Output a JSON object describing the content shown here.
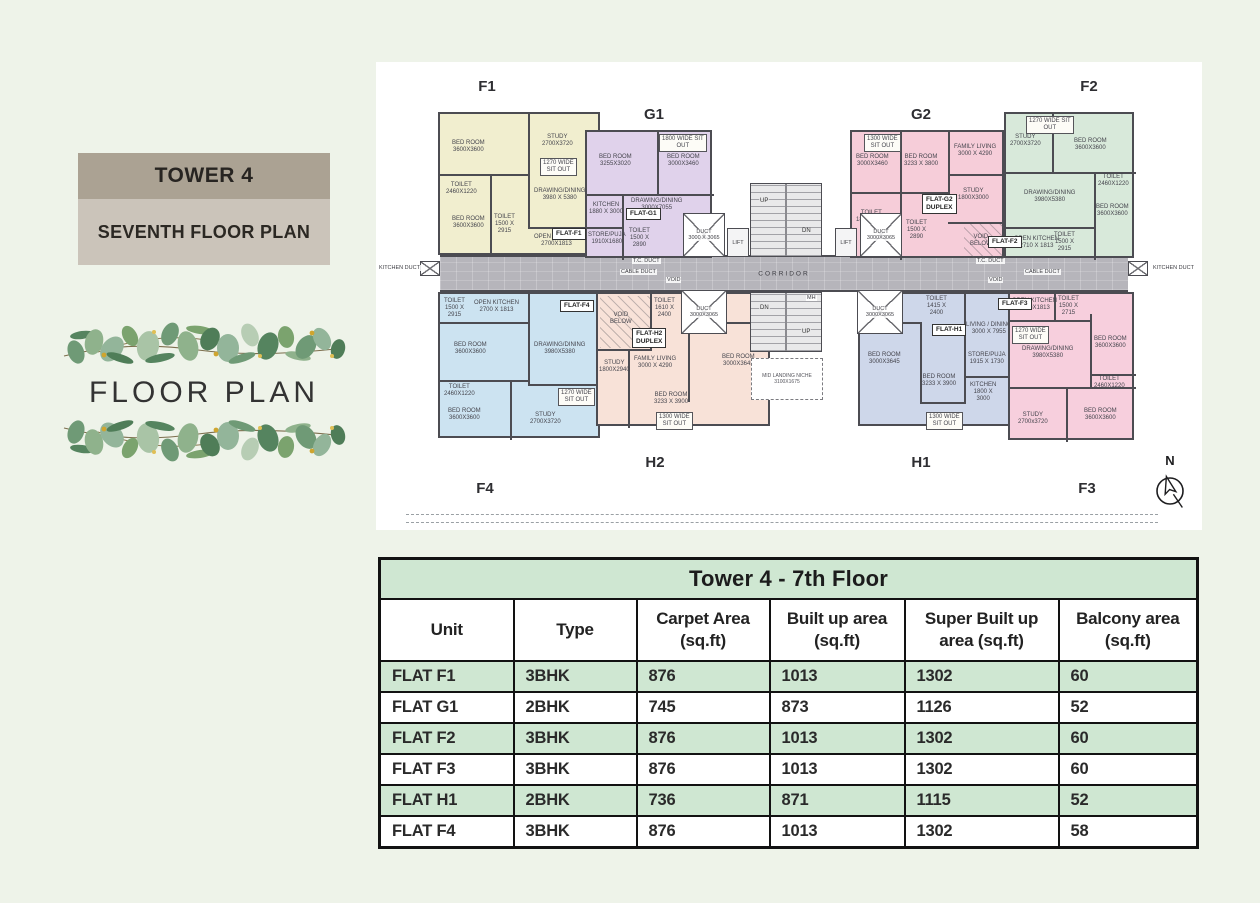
{
  "page": {
    "background": "#eef3e9"
  },
  "left_panel": {
    "tower_title": "TOWER 4",
    "subtitle": "SEVENTH FLOOR PLAN",
    "decor_heading": "FLOOR PLAN"
  },
  "colors": {
    "title_bar": "#aba293",
    "subtitle_bar": "#cbc4ba",
    "table_green": "#cfe7d2",
    "wall": "#4c4c52",
    "corridor": "#b6b5bb",
    "unit_f1": "#f1eecf",
    "unit_g1": "#e0d2eb",
    "unit_g2": "#f6cdd9",
    "unit_f2": "#d8e9da",
    "unit_f4": "#cce3f1",
    "unit_h2": "#f8e2d8",
    "unit_h1": "#ced7ea",
    "unit_f3": "#f7cfdd"
  },
  "floor_plan": {
    "compass_label": "N",
    "corridor": {
      "label": "CORRIDOR",
      "x": 64,
      "y": 193,
      "w": 688,
      "h": 37
    },
    "outer_labels": [
      {
        "t": "F1",
        "x": 111,
        "y": 16
      },
      {
        "t": "G1",
        "x": 278,
        "y": 44
      },
      {
        "t": "G2",
        "x": 545,
        "y": 44
      },
      {
        "t": "F2",
        "x": 713,
        "y": 16
      },
      {
        "t": "H2",
        "x": 279,
        "y": 392
      },
      {
        "t": "H1",
        "x": 545,
        "y": 392
      },
      {
        "t": "F4",
        "x": 109,
        "y": 418
      },
      {
        "t": "F3",
        "x": 711,
        "y": 418
      }
    ],
    "units": [
      {
        "id": "f1",
        "color_key": "unit_f1",
        "x": 62,
        "y": 50,
        "w": 162,
        "h": 143,
        "tag": {
          "t": "FLAT-F1",
          "x": 176,
          "y": 166
        },
        "walls": [
          [
            88,
            0,
            2,
            62
          ],
          [
            0,
            60,
            90,
            2
          ],
          [
            50,
            62,
            2,
            81
          ],
          [
            88,
            113,
            74,
            2
          ],
          [
            88,
            62,
            2,
            51
          ]
        ],
        "rooms": [
          {
            "t": "BED ROOM\n3600X3600",
            "x": 12,
            "y": 26
          },
          {
            "t": "STUDY\n2700X3720",
            "x": 102,
            "y": 20
          },
          {
            "t": "TOILET\n2460X1220",
            "x": 6,
            "y": 68
          },
          {
            "t": "BED ROOM\n3600X3600",
            "x": 12,
            "y": 102
          },
          {
            "t": "DRAWING/DINING\n3980 X 5380",
            "x": 94,
            "y": 74
          },
          {
            "t": "TOILET\n1500 X\n2915",
            "x": 54,
            "y": 100
          },
          {
            "t": "OPEN KITCHEN\n2700X1813",
            "x": 94,
            "y": 120
          },
          {
            "t": "1270 WIDE\nSIT OUT",
            "x": 100,
            "y": 44,
            "box": true
          }
        ]
      },
      {
        "id": "f4",
        "color_key": "unit_f4",
        "x": 62,
        "y": 230,
        "w": 162,
        "h": 146,
        "tag": {
          "t": "FLAT-F4",
          "x": 184,
          "y": 238
        },
        "walls": [
          [
            88,
            0,
            2,
            90
          ],
          [
            0,
            28,
            90,
            2
          ],
          [
            0,
            86,
            90,
            2
          ],
          [
            88,
            90,
            74,
            2
          ],
          [
            70,
            88,
            2,
            58
          ]
        ],
        "rooms": [
          {
            "t": "OPEN KITCHEN\n2700 X 1813",
            "x": 34,
            "y": 6
          },
          {
            "t": "TOILET\n1500 X\n2915",
            "x": 4,
            "y": 4
          },
          {
            "t": "DRAWING/DINING\n3980X5380",
            "x": 94,
            "y": 48
          },
          {
            "t": "BED ROOM\n3600X3600",
            "x": 14,
            "y": 48
          },
          {
            "t": "TOILET\n2460X1220",
            "x": 4,
            "y": 90
          },
          {
            "t": "BED ROOM\n3600X3600",
            "x": 8,
            "y": 114
          },
          {
            "t": "STUDY\n2700X3720",
            "x": 90,
            "y": 118
          },
          {
            "t": "1270 WIDE\nSIT OUT",
            "x": 118,
            "y": 94,
            "box": true
          }
        ]
      },
      {
        "id": "g1",
        "color_key": "unit_g1",
        "x": 209,
        "y": 68,
        "w": 127,
        "h": 128,
        "tag": {
          "t": "FLAT-G1",
          "x": 250,
          "y": 146
        },
        "walls": [
          [
            70,
            0,
            2,
            64
          ],
          [
            0,
            62,
            127,
            2
          ],
          [
            35,
            62,
            2,
            66
          ],
          [
            0,
            95,
            37,
            2
          ]
        ],
        "rooms": [
          {
            "t": "BED ROOM\n3255X3020",
            "x": 12,
            "y": 22
          },
          {
            "t": "BED ROOM\n3000X3460",
            "x": 80,
            "y": 22
          },
          {
            "t": "KITCHEN\n1880 X 3000",
            "x": 2,
            "y": 70
          },
          {
            "t": "STORE/PUJA\n1910X1680",
            "x": 1,
            "y": 100
          },
          {
            "t": "DRAWING/DINING\n3000X7055",
            "x": 44,
            "y": 66
          },
          {
            "t": "TOILET\n1500 X\n2890",
            "x": 42,
            "y": 96
          },
          {
            "t": "1800 WIDE SIT\nOUT",
            "x": 72,
            "y": 2,
            "box": true
          }
        ]
      },
      {
        "id": "g2",
        "color_key": "unit_g2",
        "x": 474,
        "y": 68,
        "w": 154,
        "h": 128,
        "tag": {
          "t": "FLAT-G2\nDUPLEX",
          "x": 546,
          "y": 132
        },
        "walls": [
          [
            48,
            0,
            2,
            62
          ],
          [
            96,
            0,
            2,
            62
          ],
          [
            0,
            60,
            98,
            2
          ],
          [
            96,
            42,
            58,
            2
          ],
          [
            48,
            62,
            2,
            66
          ],
          [
            96,
            90,
            58,
            2
          ]
        ],
        "hatches": [
          [
            112,
            92,
            40,
            34
          ]
        ],
        "rooms": [
          {
            "t": "BED ROOM\n3000X3460",
            "x": 4,
            "y": 22
          },
          {
            "t": "BED ROOM\n3233 X 3800",
            "x": 52,
            "y": 22
          },
          {
            "t": "FAMILY LIVING\n3000 X 4290",
            "x": 102,
            "y": 12
          },
          {
            "t": "STUDY\n1800X3000",
            "x": 106,
            "y": 56
          },
          {
            "t": "TOILET\n1850X2645",
            "x": 4,
            "y": 78
          },
          {
            "t": "TOILET\n1500 X\n2890",
            "x": 54,
            "y": 88
          },
          {
            "t": "VOID\nBELOW",
            "x": 118,
            "y": 102
          },
          {
            "t": "1300 WIDE\nSIT OUT",
            "x": 12,
            "y": 2,
            "box": true
          }
        ]
      },
      {
        "id": "f2",
        "color_key": "unit_f2",
        "x": 628,
        "y": 50,
        "w": 130,
        "h": 146,
        "tag": {
          "t": "FLAT-F2",
          "x": 612,
          "y": 174
        },
        "walls": [
          [
            46,
            0,
            2,
            60
          ],
          [
            0,
            58,
            130,
            2
          ],
          [
            88,
            58,
            2,
            88
          ],
          [
            0,
            113,
            88,
            2
          ]
        ],
        "rooms": [
          {
            "t": "STUDY\n2700X3720",
            "x": 4,
            "y": 20
          },
          {
            "t": "BED ROOM\n3600X3600",
            "x": 68,
            "y": 24
          },
          {
            "t": "TOILET\n2460X1220",
            "x": 92,
            "y": 60
          },
          {
            "t": "DRAWING/DINING\n3980X5380",
            "x": 18,
            "y": 76
          },
          {
            "t": "BED ROOM\n3600X3600",
            "x": 90,
            "y": 90
          },
          {
            "t": "OPEN KITCHEN\n2710 X 1813",
            "x": 8,
            "y": 122
          },
          {
            "t": "TOILET\n1500 X\n2915",
            "x": 48,
            "y": 118
          },
          {
            "t": "1270 WIDE SIT\nOUT",
            "x": 20,
            "y": 2,
            "box": true
          }
        ]
      },
      {
        "id": "h2",
        "color_key": "unit_h2",
        "x": 220,
        "y": 230,
        "w": 174,
        "h": 134,
        "tag": {
          "t": "FLAT-H2\nDUPLEX",
          "x": 256,
          "y": 266
        },
        "walls": [
          [
            52,
            0,
            2,
            57
          ],
          [
            0,
            55,
            54,
            2
          ],
          [
            30,
            55,
            2,
            79
          ],
          [
            90,
            28,
            2,
            80
          ],
          [
            120,
            28,
            54,
            2
          ]
        ],
        "hatches": [
          [
            2,
            2,
            50,
            52
          ]
        ],
        "rooms": [
          {
            "t": "VOID\nBELOW",
            "x": 12,
            "y": 18
          },
          {
            "t": "TOILET\n1610 X\n2400",
            "x": 56,
            "y": 4
          },
          {
            "t": "STUDY\n1800X2940",
            "x": 1,
            "y": 66
          },
          {
            "t": "FAMILY LIVING\n3000 X 4290",
            "x": 36,
            "y": 62
          },
          {
            "t": "BED ROOM\n3233 X 3900",
            "x": 56,
            "y": 98
          },
          {
            "t": "BED ROOM\n3000X3645",
            "x": 124,
            "y": 60
          },
          {
            "t": "1300 WIDE\nSIT OUT",
            "x": 58,
            "y": 118,
            "box": true
          }
        ]
      },
      {
        "id": "h1",
        "color_key": "unit_h1",
        "x": 482,
        "y": 230,
        "w": 158,
        "h": 134,
        "tag": {
          "t": "FLAT-H1",
          "x": 556,
          "y": 262
        },
        "walls": [
          [
            0,
            28,
            62,
            2
          ],
          [
            60,
            28,
            2,
            82
          ],
          [
            104,
            0,
            2,
            110
          ],
          [
            104,
            82,
            54,
            2
          ],
          [
            60,
            108,
            44,
            2
          ]
        ],
        "rooms": [
          {
            "t": "TOILET\n1505 X\n3095",
            "x": 4,
            "y": 2
          },
          {
            "t": "TOILET\n1415 X\n2400",
            "x": 66,
            "y": 2
          },
          {
            "t": "BED ROOM\n3000X3645",
            "x": 8,
            "y": 58
          },
          {
            "t": "BED ROOM\n3233 X 3900",
            "x": 62,
            "y": 80
          },
          {
            "t": "LIVING / DINING\n3000 X 7955",
            "x": 106,
            "y": 28
          },
          {
            "t": "KITCHEN\n1800 X\n3000",
            "x": 110,
            "y": 88
          },
          {
            "t": "STORE/PUJA\n1915 X 1730",
            "x": 108,
            "y": 58
          },
          {
            "t": "1300 WIDE\nSIT OUT",
            "x": 66,
            "y": 118,
            "box": true
          }
        ]
      },
      {
        "id": "f3",
        "color_key": "unit_f3",
        "x": 632,
        "y": 230,
        "w": 126,
        "h": 148,
        "tag": {
          "t": "FLAT-F3",
          "x": 622,
          "y": 236
        },
        "walls": [
          [
            44,
            0,
            2,
            28
          ],
          [
            0,
            26,
            80,
            2
          ],
          [
            80,
            20,
            2,
            75
          ],
          [
            0,
            93,
            126,
            2
          ],
          [
            56,
            95,
            2,
            53
          ],
          [
            80,
            80,
            46,
            2
          ]
        ],
        "rooms": [
          {
            "t": "OPEN KITCHEN\n2700X1813",
            "x": 2,
            "y": 4
          },
          {
            "t": "TOILET\n1500 X\n2715",
            "x": 48,
            "y": 2
          },
          {
            "t": "DRAWING/DINING\n3980X5380",
            "x": 12,
            "y": 52
          },
          {
            "t": "BED ROOM\n3600X3600",
            "x": 84,
            "y": 42
          },
          {
            "t": "TOILET\n2460X1220",
            "x": 84,
            "y": 82
          },
          {
            "t": "BED ROOM\n3600X3600",
            "x": 74,
            "y": 114
          },
          {
            "t": "STUDY\n2700x3720",
            "x": 8,
            "y": 118
          },
          {
            "t": "1270 WIDE\nSIT OUT",
            "x": 2,
            "y": 32,
            "box": true
          }
        ]
      }
    ],
    "cores": [
      {
        "type": "duct",
        "x": 307,
        "y": 151,
        "w": 42,
        "h": 44,
        "t": "DUCT\n3000 X 3065"
      },
      {
        "type": "duct",
        "x": 484,
        "y": 151,
        "w": 42,
        "h": 44,
        "t": "DUCT\n3000X3065"
      },
      {
        "type": "duct",
        "x": 305,
        "y": 228,
        "w": 46,
        "h": 44,
        "t": "DUCT\n3000X3065"
      },
      {
        "type": "duct",
        "x": 481,
        "y": 228,
        "w": 46,
        "h": 44,
        "t": "DUCT\n3000X3065"
      },
      {
        "type": "duct",
        "x": 44,
        "y": 199,
        "w": 20,
        "h": 15,
        "t": ""
      },
      {
        "type": "duct",
        "x": 752,
        "y": 199,
        "w": 20,
        "h": 15,
        "t": ""
      },
      {
        "type": "lift",
        "x": 351,
        "y": 166,
        "w": 22,
        "h": 29,
        "t": "LIFT"
      },
      {
        "type": "lift",
        "x": 459,
        "y": 166,
        "w": 22,
        "h": 29,
        "t": "LIFT"
      },
      {
        "type": "stair",
        "x": 374,
        "y": 121,
        "w": 72,
        "h": 74,
        "labels": [
          {
            "t": "UP",
            "x": 8,
            "y": 14
          },
          {
            "t": "DN",
            "x": 50,
            "y": 44
          }
        ]
      },
      {
        "type": "stair",
        "x": 374,
        "y": 230,
        "w": 72,
        "h": 60,
        "labels": [
          {
            "t": "DN",
            "x": 8,
            "y": 12
          },
          {
            "t": "UP",
            "x": 50,
            "y": 36
          }
        ]
      },
      {
        "type": "niche",
        "x": 375,
        "y": 296,
        "w": 72,
        "h": 42,
        "t": "MID LANDING NICHE\n3100X1675"
      }
    ],
    "annotations": [
      {
        "t": "KITCHEN DUCT",
        "x": 2,
        "y": 203
      },
      {
        "t": "KITCHEN DUCT",
        "x": 776,
        "y": 203
      },
      {
        "t": "T.C. DUCT",
        "x": 256,
        "y": 196
      },
      {
        "t": "T.C. DUCT",
        "x": 600,
        "y": 196
      },
      {
        "t": "CABLE DUCT",
        "x": 244,
        "y": 207
      },
      {
        "t": "VOID",
        "x": 290,
        "y": 215
      },
      {
        "t": "VOID",
        "x": 612,
        "y": 215
      },
      {
        "t": "CABLE DUCT",
        "x": 648,
        "y": 207
      },
      {
        "t": "MH",
        "x": 430,
        "y": 233
      }
    ]
  },
  "table": {
    "title": "Tower 4 - 7th Floor",
    "headers": [
      "Unit",
      "Type",
      "Carpet Area\n(sq.ft)",
      "Built up area\n(sq.ft)",
      "Super Built up\narea (sq.ft)",
      "Balcony area\n(sq.ft)"
    ],
    "rows": [
      [
        "FLAT F1",
        "3BHK",
        "876",
        "1013",
        "1302",
        "60"
      ],
      [
        "FLAT G1",
        "2BHK",
        "745",
        "873",
        "1126",
        "52"
      ],
      [
        "FLAT F2",
        "3BHK",
        "876",
        "1013",
        "1302",
        "60"
      ],
      [
        "FLAT F3",
        "3BHK",
        "876",
        "1013",
        "1302",
        "60"
      ],
      [
        "FLAT H1",
        "2BHK",
        "736",
        "871",
        "1115",
        "52"
      ],
      [
        "FLAT F4",
        "3BHK",
        "876",
        "1013",
        "1302",
        "58"
      ]
    ]
  }
}
